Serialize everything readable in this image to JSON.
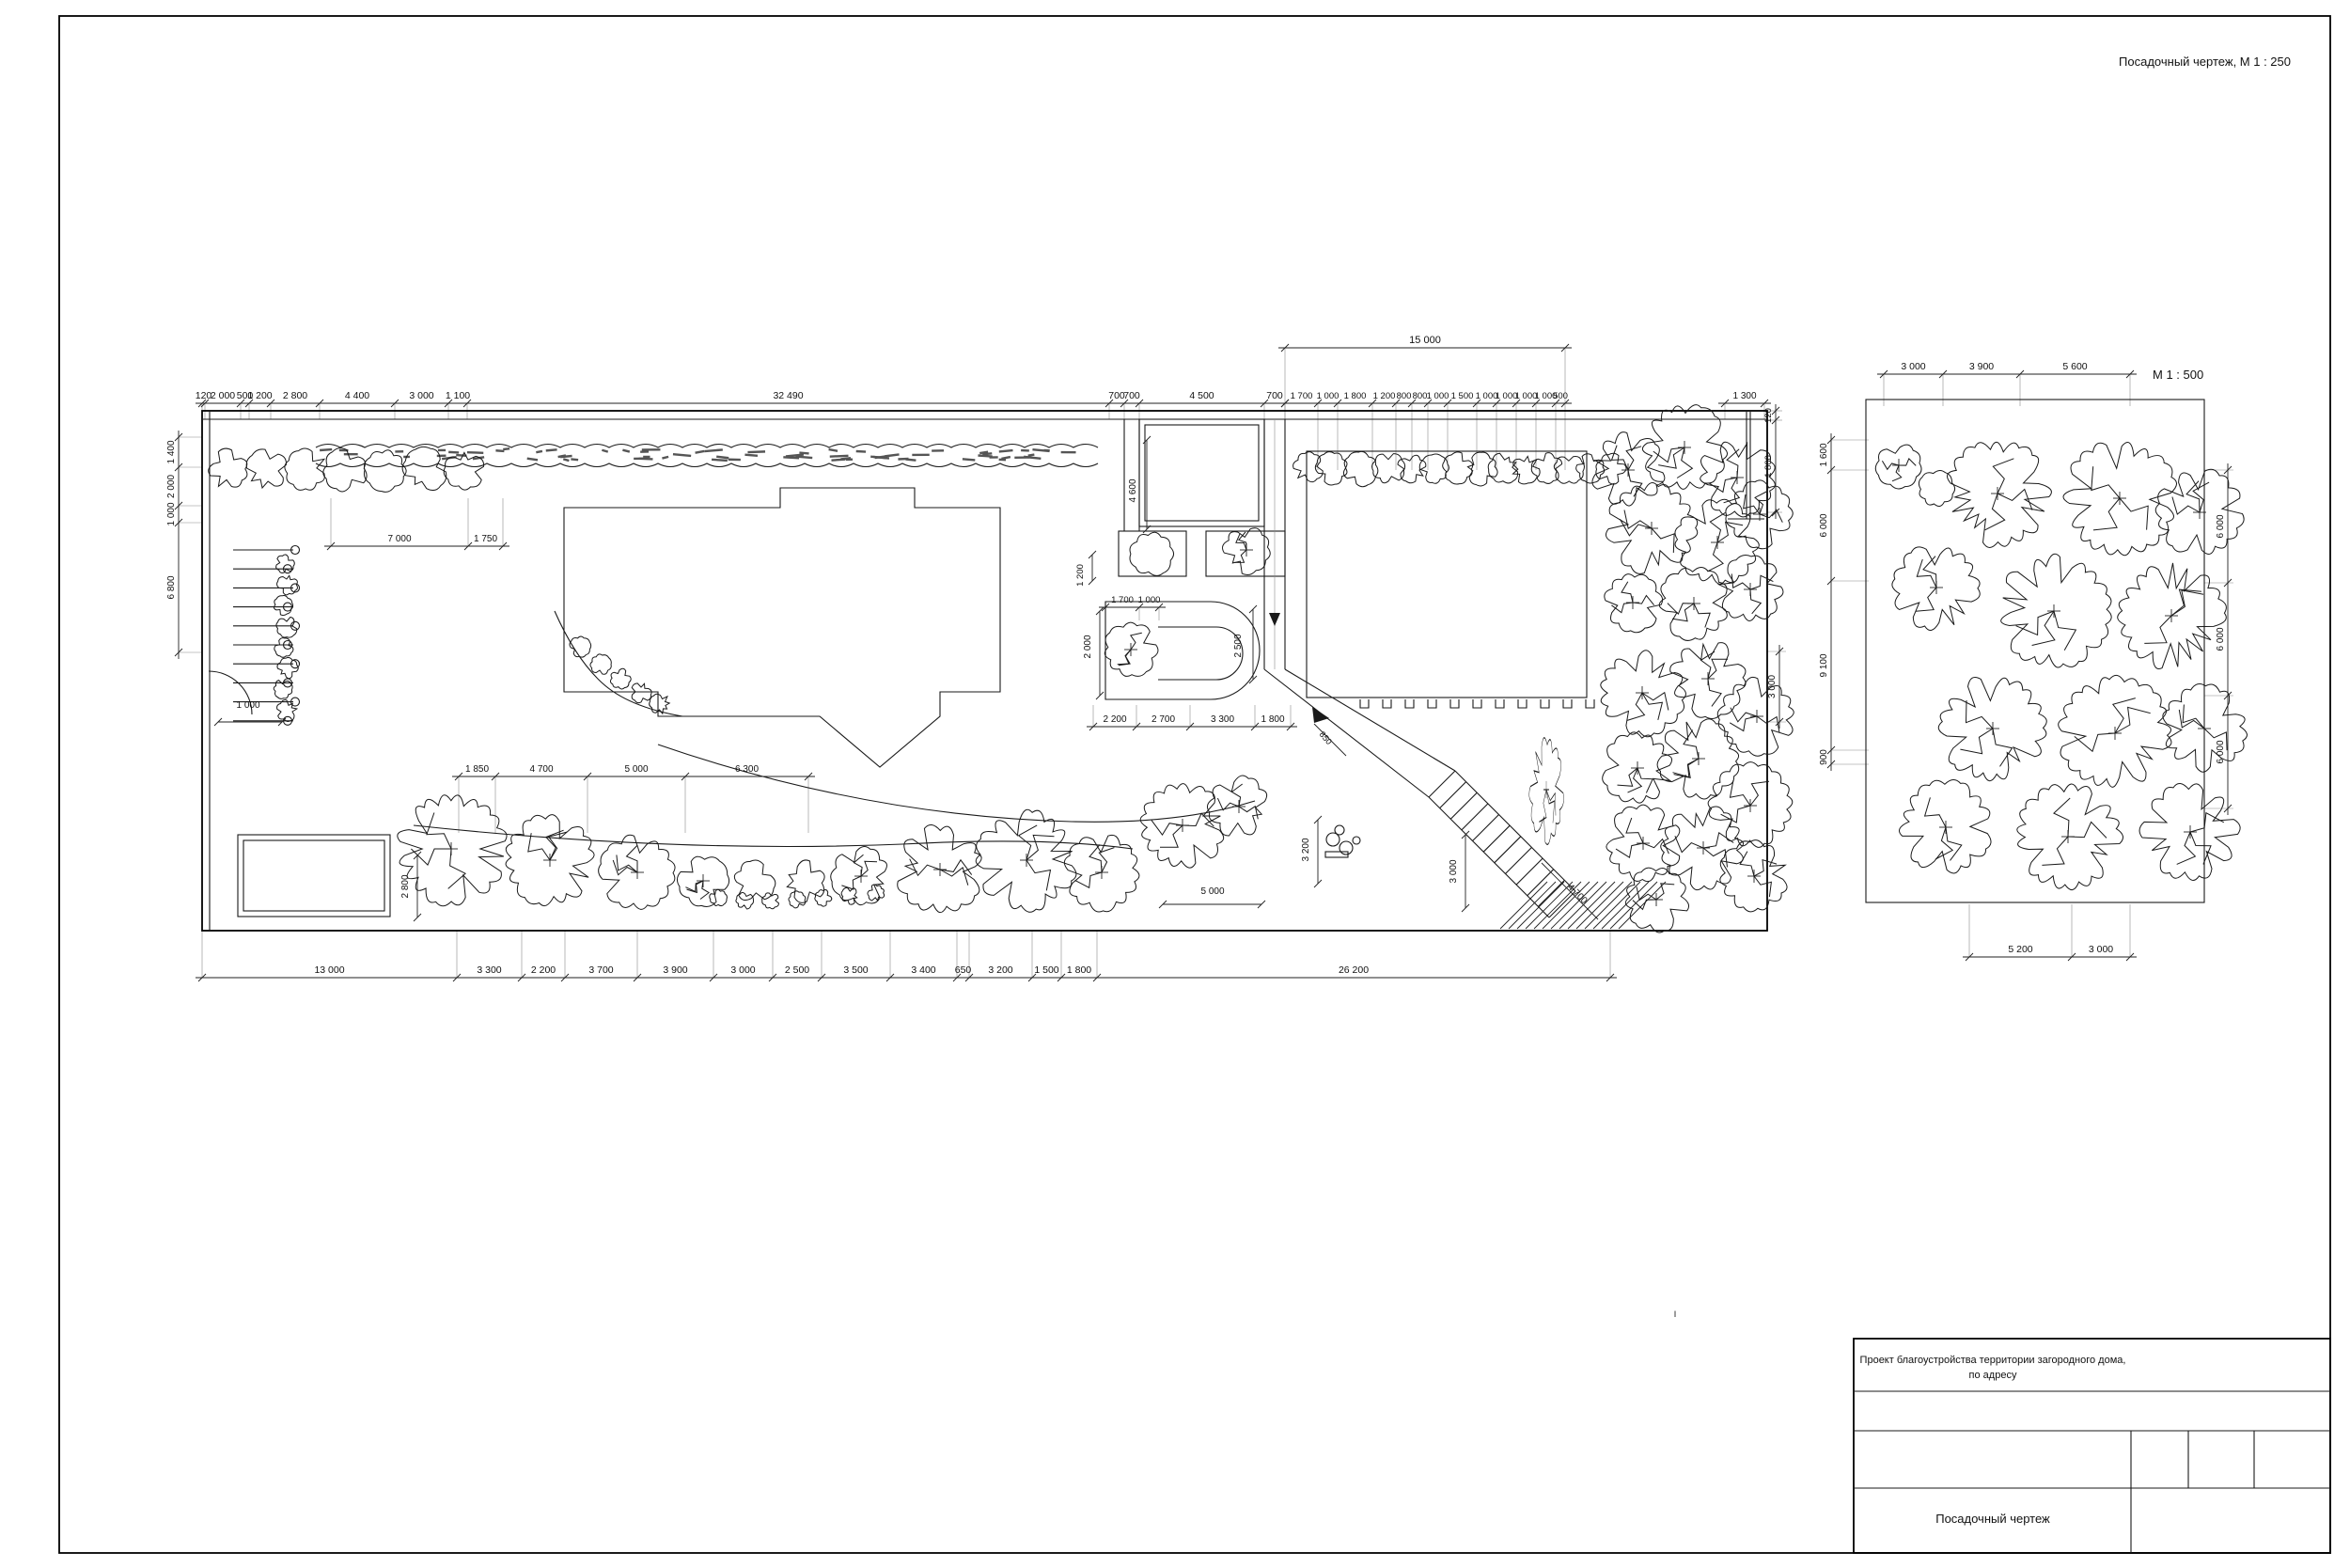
{
  "page": {
    "top_label": "Посадочный чертеж, М 1 : 250",
    "stray_mark": "I"
  },
  "title_block": {
    "project_line1": "Проект благоустройства территории загородного дома,",
    "project_line2": "по адресу",
    "drawing_title": "Посадочный чертеж"
  },
  "main_plan": {
    "dims_top": [
      "120",
      "2 000",
      "500",
      "1 200",
      "2 800",
      "4 400",
      "3 000",
      "1 100",
      "32 490",
      "700",
      "700",
      "4 500",
      "700"
    ],
    "dims_top_fine": [
      "1 700",
      "1 000",
      "1 800",
      "1 200",
      "800",
      "800",
      "1 000",
      "1 500",
      "1 000",
      "1 000",
      "1 000",
      "1 000",
      "500"
    ],
    "dim_top_overall": [
      "15 000"
    ],
    "dim_top_right": [
      "1 300"
    ],
    "dims_right_top": [
      "120",
      "1 800"
    ],
    "dim_right_mid": [
      "3 000"
    ],
    "dims_left": [
      "1 400",
      "2 000",
      "1 000",
      "6 800"
    ],
    "dim_gate": "1 000",
    "dims_bottom": [
      "13 000",
      "3 300",
      "2 200",
      "3 700",
      "3 900",
      "3 000",
      "2 500",
      "3 500",
      "3 400",
      "650",
      "3 200",
      "1 500",
      "1 800",
      "26 200"
    ],
    "inner": {
      "row_top": [
        "7 000",
        "1 750"
      ],
      "row_mid": [
        "1 850",
        "4 700",
        "5 000",
        "6 300"
      ],
      "pool_top": [
        "1 700",
        "1 000"
      ],
      "below_pool": [
        "2 200",
        "2 700",
        "3 300",
        "1 800"
      ],
      "planter_left_dim": "1 200",
      "walk_top_dim": "4 600",
      "pool_left_dim": "2 000",
      "pool_right_dim": "2 500",
      "shed_left_dim": "2 800",
      "path_diag_dim": "850",
      "terrace_width_dim": "3 200",
      "terrace_len_dim": "5 000",
      "stairs_height_dim": "3 000",
      "stairs_diag_dim": "4 700"
    }
  },
  "detail_plan": {
    "scale_label": "М 1 : 500",
    "dims_top": [
      "3 000",
      "3 900",
      "5 600"
    ],
    "dims_left": [
      "1 600",
      "6 000",
      "9 100",
      "900"
    ],
    "dims_right": [
      "6 000",
      "6 000",
      "6 000"
    ],
    "dims_bottom": [
      "5 200",
      "3 000"
    ]
  }
}
